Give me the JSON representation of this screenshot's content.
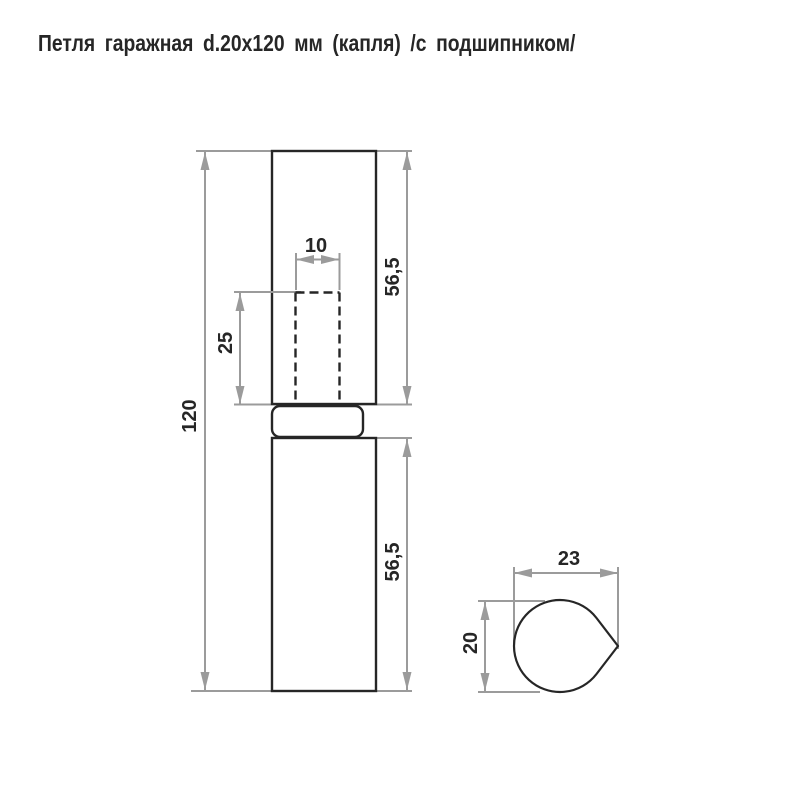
{
  "title": "Петля гаражная d.20x120 мм (капля) /с подшипником/",
  "front_view": {
    "dim_overall_length": "120",
    "dim_upper_leaf_length": "56,5",
    "dim_lower_leaf_length": "56,5",
    "dim_pin_hole_width": "10",
    "dim_pin_hole_depth": "25"
  },
  "section_view": {
    "dim_section_width": "23",
    "dim_section_height": "20"
  },
  "colors": {
    "outline": "#262626",
    "dimension_lines": "#9b9b9b",
    "background": "#ffffff"
  }
}
